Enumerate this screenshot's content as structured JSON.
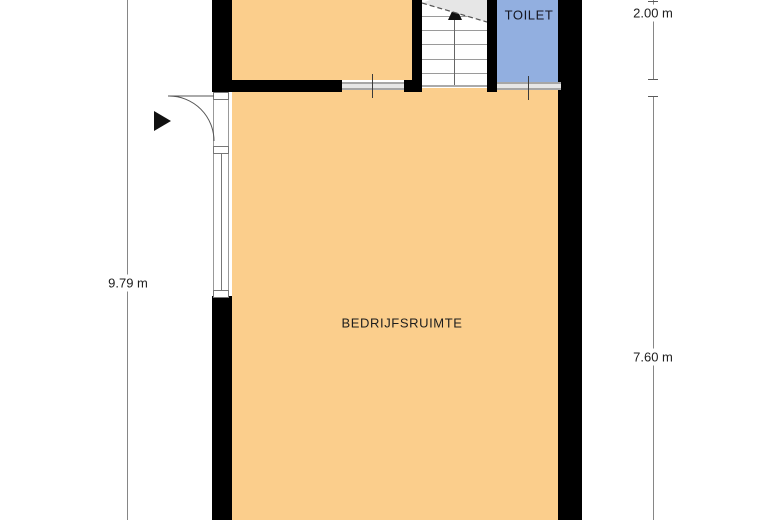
{
  "floorplan": {
    "rooms": {
      "bedrijfsruimte": {
        "label": "BEDRIJFSRUIMTE",
        "fill": "#FBCE8C"
      },
      "top_left_room": {
        "fill": "#FBCE8C"
      },
      "toilet": {
        "label": "TOILET",
        "fill": "#92AFE0"
      }
    },
    "dimensions": {
      "left": {
        "label": "9.79 m"
      },
      "right_top": {
        "label": "2.00 m"
      },
      "right_bottom": {
        "label": "7.60 m"
      }
    },
    "icons": {
      "stairs_up_arrow": "▲",
      "entrance_arrow": "▶",
      "door_swing": "quarter-arc"
    },
    "colors": {
      "wall": "#000000",
      "room_fill": "#FBCE8C",
      "toilet_fill": "#92AFE0",
      "stair_break_fill": "#E6E6E6",
      "threshold": "#A6A6A6",
      "dimension_line": "#868686"
    }
  }
}
